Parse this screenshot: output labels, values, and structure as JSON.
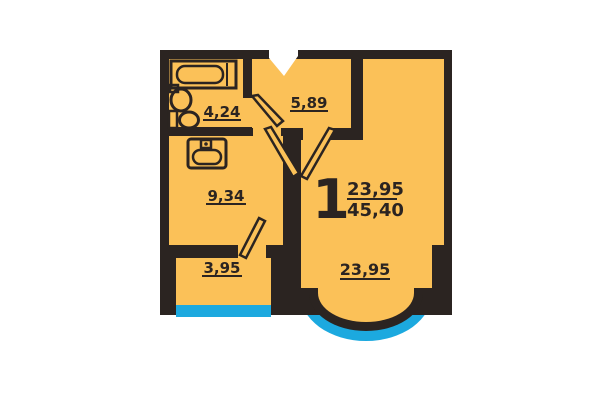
{
  "plan": {
    "apartment_number": "1",
    "area_fraction": {
      "top": "23,95",
      "bottom": "45,40"
    },
    "rooms": [
      {
        "id": "bathroom",
        "area": "4,24"
      },
      {
        "id": "hallway",
        "area": "5,89"
      },
      {
        "id": "kitchen",
        "area": "9,34"
      },
      {
        "id": "loggia",
        "area": "3,95"
      },
      {
        "id": "living-room",
        "area": "23,95"
      }
    ],
    "fixtures": [
      "bathtub-icon",
      "sink-icon",
      "toilet-icon",
      "kitchen-sink-icon",
      "entrance-door-icon"
    ],
    "colors": {
      "walls": "#2B2421",
      "floor": "#FBC158",
      "glazing": "#1CA9DF",
      "background": "#FFFFFF",
      "label_text": "#2B2421"
    }
  }
}
